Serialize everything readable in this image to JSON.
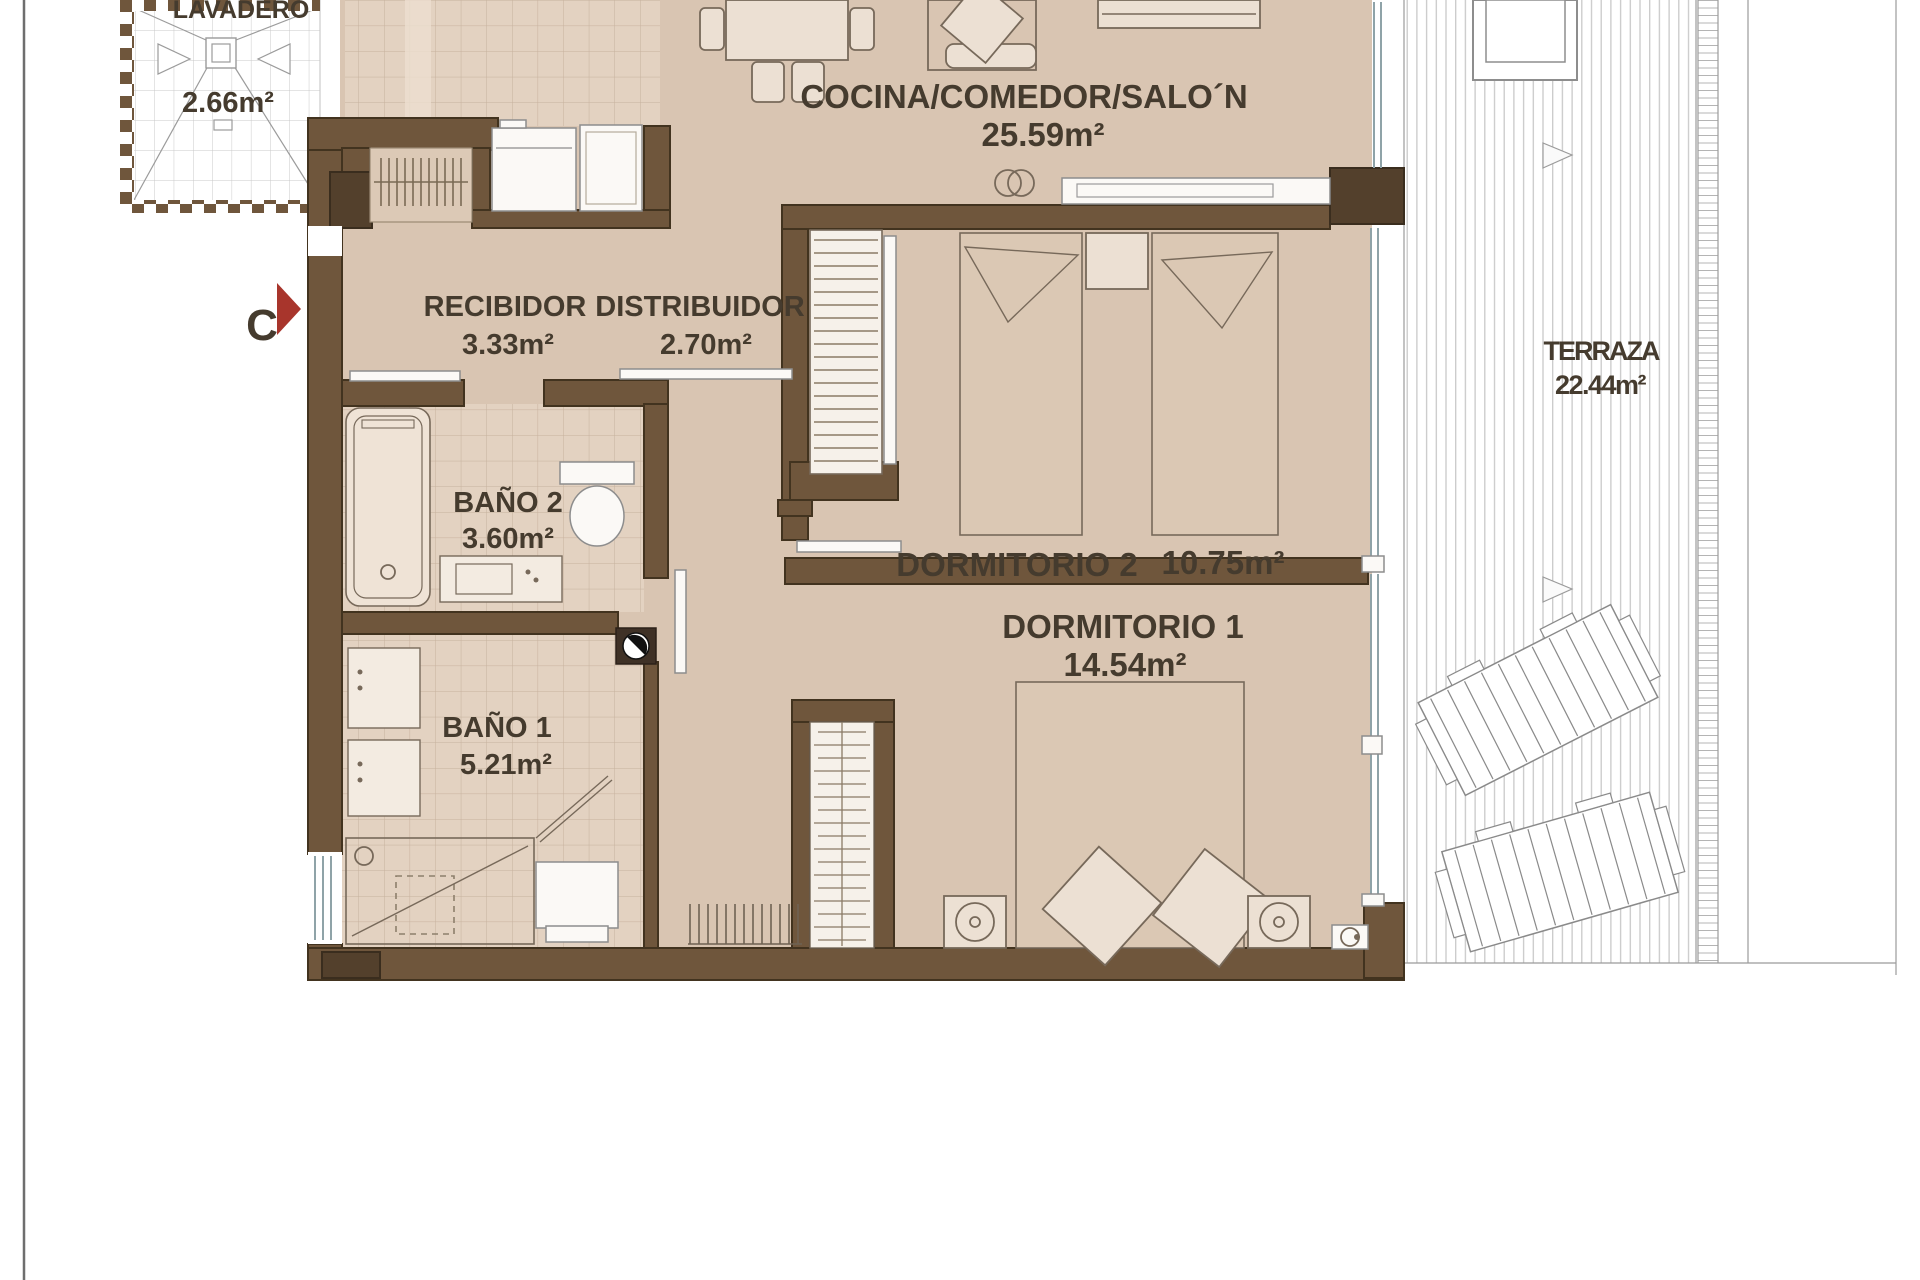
{
  "plan": {
    "title": "apartment-floor-plan",
    "marker": {
      "label": "C"
    },
    "rooms": [
      {
        "name": "lavadero",
        "label": "LAVADERO",
        "area": "2.66m²"
      },
      {
        "name": "cocina-comedor-salon",
        "label": "COCINA/COMEDOR/SALO´N",
        "area": "25.59m²"
      },
      {
        "name": "recibidor",
        "label": "RECIBIDOR",
        "area": "3.33m²"
      },
      {
        "name": "distribuidor",
        "label": "DISTRIBUIDOR",
        "area": "2.70m²"
      },
      {
        "name": "bano-2",
        "label": "BAÑO 2",
        "area": "3.60m²"
      },
      {
        "name": "dormitorio-2",
        "label": "DORMITORIO 2",
        "area": "10.75m²"
      },
      {
        "name": "bano-1",
        "label": "BAÑO 1",
        "area": "5.21m²"
      },
      {
        "name": "dormitorio-1",
        "label": "DORMITORIO 1",
        "area": "14.54m²"
      },
      {
        "name": "terraza",
        "label": "TERRAZA",
        "area": "22.44m²"
      }
    ],
    "colors": {
      "floor_beige": "#d9c5b2",
      "tile": "#e3d2c1",
      "wall_brown": "#6f563c",
      "wall_dark": "#53402c",
      "marker_red": "#a8352c",
      "deck_line": "#c9c9c9",
      "text": "#453b2e"
    }
  }
}
